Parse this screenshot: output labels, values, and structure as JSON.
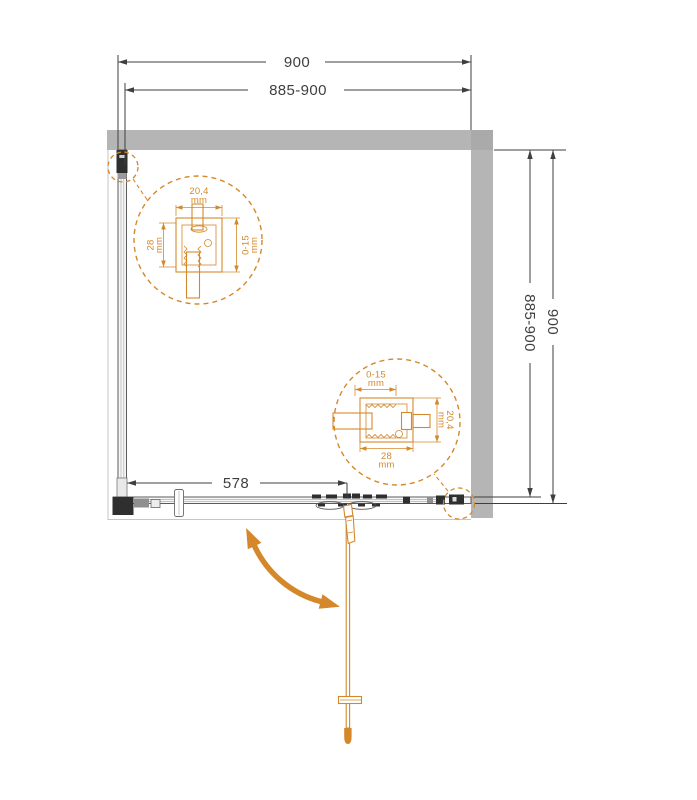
{
  "drawing": {
    "dims": {
      "top_outer": "900",
      "top_inner": "885-900",
      "right_inner": "885-900",
      "right_outer": "900",
      "fixed_panel": "578"
    },
    "detail_top_left": {
      "top_value": "20,4",
      "top_unit": "mm",
      "left_value": "28",
      "left_unit": "mm",
      "right_value": "0-15",
      "right_unit": "mm"
    },
    "detail_bottom_right": {
      "top_value": "0-15",
      "top_unit": "mm",
      "bottom_value": "28",
      "bottom_unit": "mm",
      "right_value": "20,4",
      "right_unit": "mm"
    },
    "colors": {
      "accent_orange": "#d4882a",
      "wall_gray": "#b5b5b5",
      "wall_corner_gray": "#aaaaaa",
      "line_dark": "#3f3f3f"
    }
  }
}
